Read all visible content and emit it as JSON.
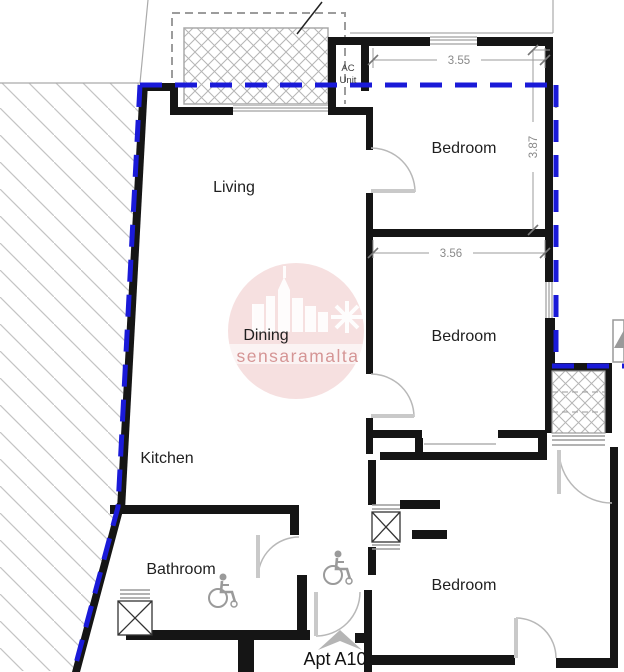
{
  "plan": {
    "rooms": {
      "living": "Living",
      "dining": "Dining",
      "kitchen": "Kitchen",
      "bathroom": "Bathroom",
      "bedroom_top": "Bedroom",
      "bedroom_mid": "Bedroom",
      "bedroom_bottom": "Bedroom"
    },
    "annotations": {
      "ac_line1": "AC",
      "ac_line2": "Unit",
      "apartment": "Apt A10"
    },
    "dimensions": {
      "bed_top_width": "3.55",
      "bed_top_depth": "3.87",
      "bed_mid_width": "3.56"
    },
    "watermark": "sensaramalta",
    "colors": {
      "boundary_blue": "#1a1ad8",
      "wall_black": "#151515",
      "dimension_gray": "#8a8a8a",
      "watermark_pink": "#dd8888"
    }
  }
}
